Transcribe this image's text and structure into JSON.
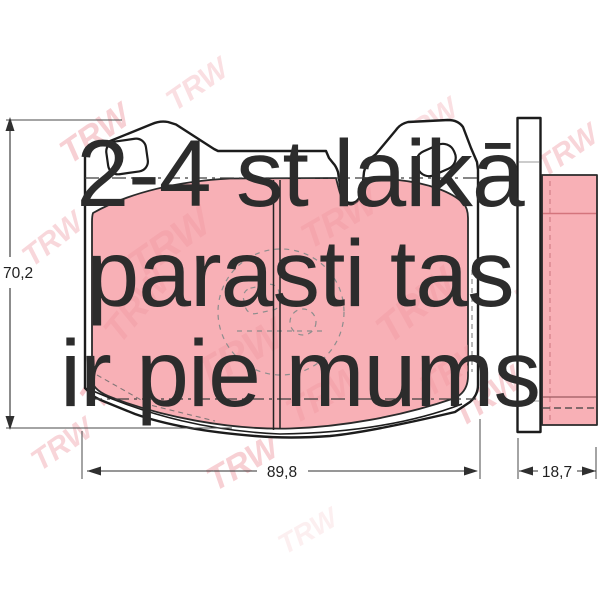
{
  "overlay": {
    "lines": [
      "2-4 st laikā",
      "parasti tas",
      "ir pie mums"
    ]
  },
  "dimensions": {
    "height_label": "70,2",
    "width_label": "89,8",
    "thickness_label": "18,7"
  },
  "watermark": {
    "brand": "TRW"
  },
  "colors": {
    "friction_color": "#f8b0b6",
    "outline_color": "#1c1c1c",
    "text_color": "#2c2c2c",
    "watermark_color": "#ef99a1",
    "dim_color": "#2f2f2f"
  }
}
